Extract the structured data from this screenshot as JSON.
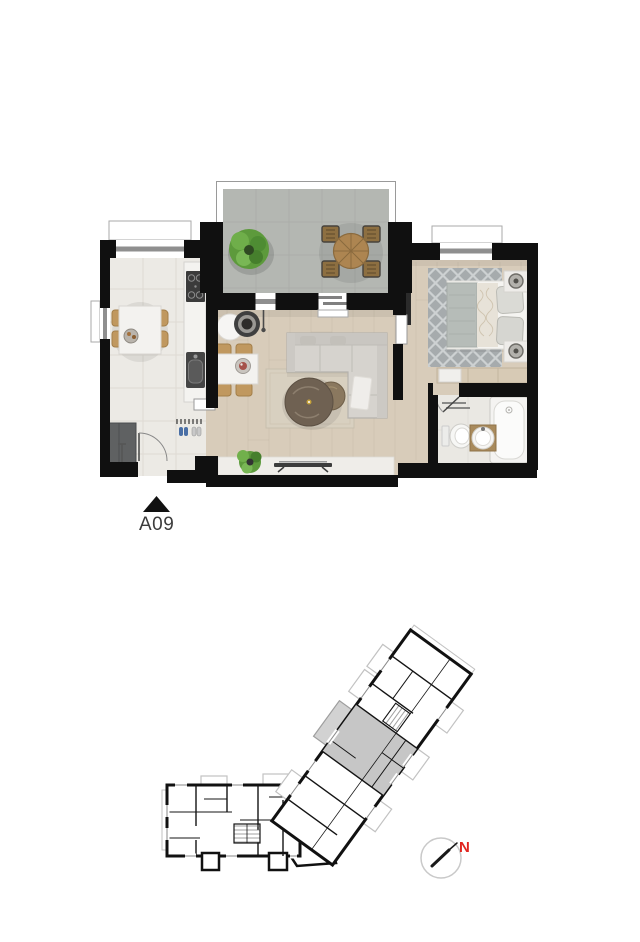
{
  "floor_plan": {
    "unit_label": "A09",
    "entrance_marker": "triangle-up-icon",
    "colors": {
      "wall": "#101010",
      "wood_floor": "#d8ccba",
      "kitchen_tile": "#eceae5",
      "terrace_tile": "#b4b7b2",
      "bathroom_tile": "#eae8e3",
      "living_rug": "#d8d0c0",
      "bedroom_rug": "#a6abad",
      "sofa": "#d6d3ce",
      "plant_green": "#5d9a3c",
      "chair_wood": "#c0985f",
      "white_furniture": "#f3f2ef",
      "window_frame": "#8f8f8f"
    },
    "furniture": [
      "terrace-plant",
      "terrace-table-set",
      "kitchen-dining-table",
      "kitchen-counter",
      "stove",
      "kitchen-sink",
      "entry-wardrobe",
      "entry-shoes",
      "living-side-table",
      "living-planter",
      "living-dining-table",
      "l-shaped-sofa",
      "coffee-tables",
      "living-rug",
      "tv",
      "window-sill-plant",
      "bed",
      "pillows",
      "bedside-lamps",
      "bedroom-rug",
      "closet",
      "wall-tv",
      "bathtub",
      "toilet",
      "washbasin",
      "towel-rails"
    ]
  },
  "site_plan": {
    "highlighted_unit": "A09",
    "highlight_color": "#c6c6c6",
    "outline_color": "#111111",
    "balcony_outline_color": "#c2c2c2"
  },
  "compass": {
    "north_label": "N",
    "north_color": "#e1251f",
    "circle_color": "#c9c9c9",
    "needle_color": "#1a1a1a"
  }
}
